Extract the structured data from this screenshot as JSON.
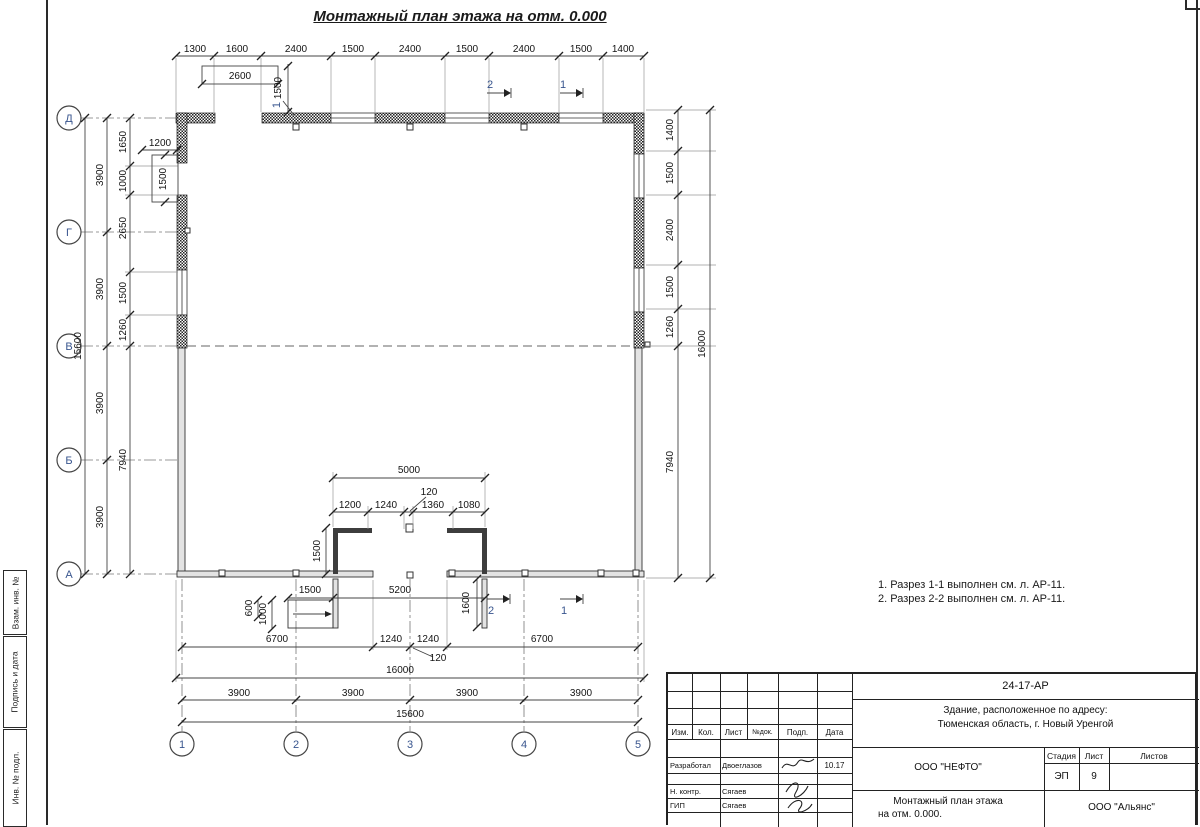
{
  "frame": {
    "sidebar_labels": [
      "Взам. инв. №",
      "Подпись и дата",
      "Инв. № подл."
    ]
  },
  "title": "Монтажный план этажа на отм. 0.000",
  "notes": [
    "1. Разрез 1-1 выполнен см. л. АР-11.",
    "2. Разрез 2-2 выполнен см. л. АР-11."
  ],
  "plan": {
    "axes_h": [
      "1",
      "2",
      "3",
      "4",
      "5"
    ],
    "axes_v": [
      "Д",
      "Г",
      "В",
      "Б",
      "А"
    ],
    "dim_top": [
      "1300",
      "1600",
      "2400",
      "1500",
      "2400",
      "1500",
      "2400",
      "1500",
      "1400"
    ],
    "dim_top_opening": "2600",
    "dim_top_window": "1500",
    "dim_left_total": "15600",
    "dim_left_bays": [
      "3900",
      "3900",
      "3900",
      "3900"
    ],
    "dim_left_inner": [
      "1650",
      "1000",
      "2650",
      "1500",
      "1260",
      "7940"
    ],
    "dim_left_opening_w": "1200",
    "dim_left_opening_h": "1500",
    "dim_right_inner": [
      "1400",
      "1500",
      "2400",
      "1500",
      "1260",
      "7940"
    ],
    "dim_right_total": "16000",
    "dim_vest_total": "5000",
    "dim_vest_chain": [
      "1200",
      "1240",
      "1360",
      "1080"
    ],
    "dim_vest_part": "120",
    "dim_vest_depth": "1500",
    "dim_ramp_w": "1500",
    "dim_porch_w": "5200",
    "dim_ramp_h1": "600",
    "dim_ramp_h2": "1000",
    "dim_porch_d": "1600",
    "dim_bot_chain": [
      "6700",
      "1240",
      "1240",
      "6700"
    ],
    "dim_bot_part": "120",
    "dim_bot_total": "16000",
    "dim_bot_bays": [
      "3900",
      "3900",
      "3900",
      "3900"
    ],
    "dim_bot_overall": "15600",
    "sections": [
      "1",
      "2"
    ],
    "callout": "1"
  },
  "titleblock": {
    "doc_number": "24-17-АР",
    "object_line1": "Здание, расположенное по адресу:",
    "object_line2": "Тюменская область, г. Новый Уренгой",
    "company": "ООО \"НЕФТО\"",
    "stage_label": "Стадия",
    "sheet_label": "Лист",
    "sheets_label": "Листов",
    "stage": "ЭП",
    "sheet": "9",
    "sheets": "",
    "title_line1": "Монтажный план этажа",
    "title_line2": "на отм. 0.000.",
    "contractor": "ООО \"Альянс\"",
    "cols": [
      "Изм.",
      "Кол.",
      "Лист",
      "№док.",
      "Подп.",
      "Дата"
    ],
    "rows": [
      {
        "role": "Разработал",
        "name": "Двоеглазов",
        "date": "10.17"
      },
      {
        "role": "Н. контр.",
        "name": "Сягаев",
        "date": ""
      },
      {
        "role": "ГИП",
        "name": "Сягаев",
        "date": ""
      }
    ]
  }
}
